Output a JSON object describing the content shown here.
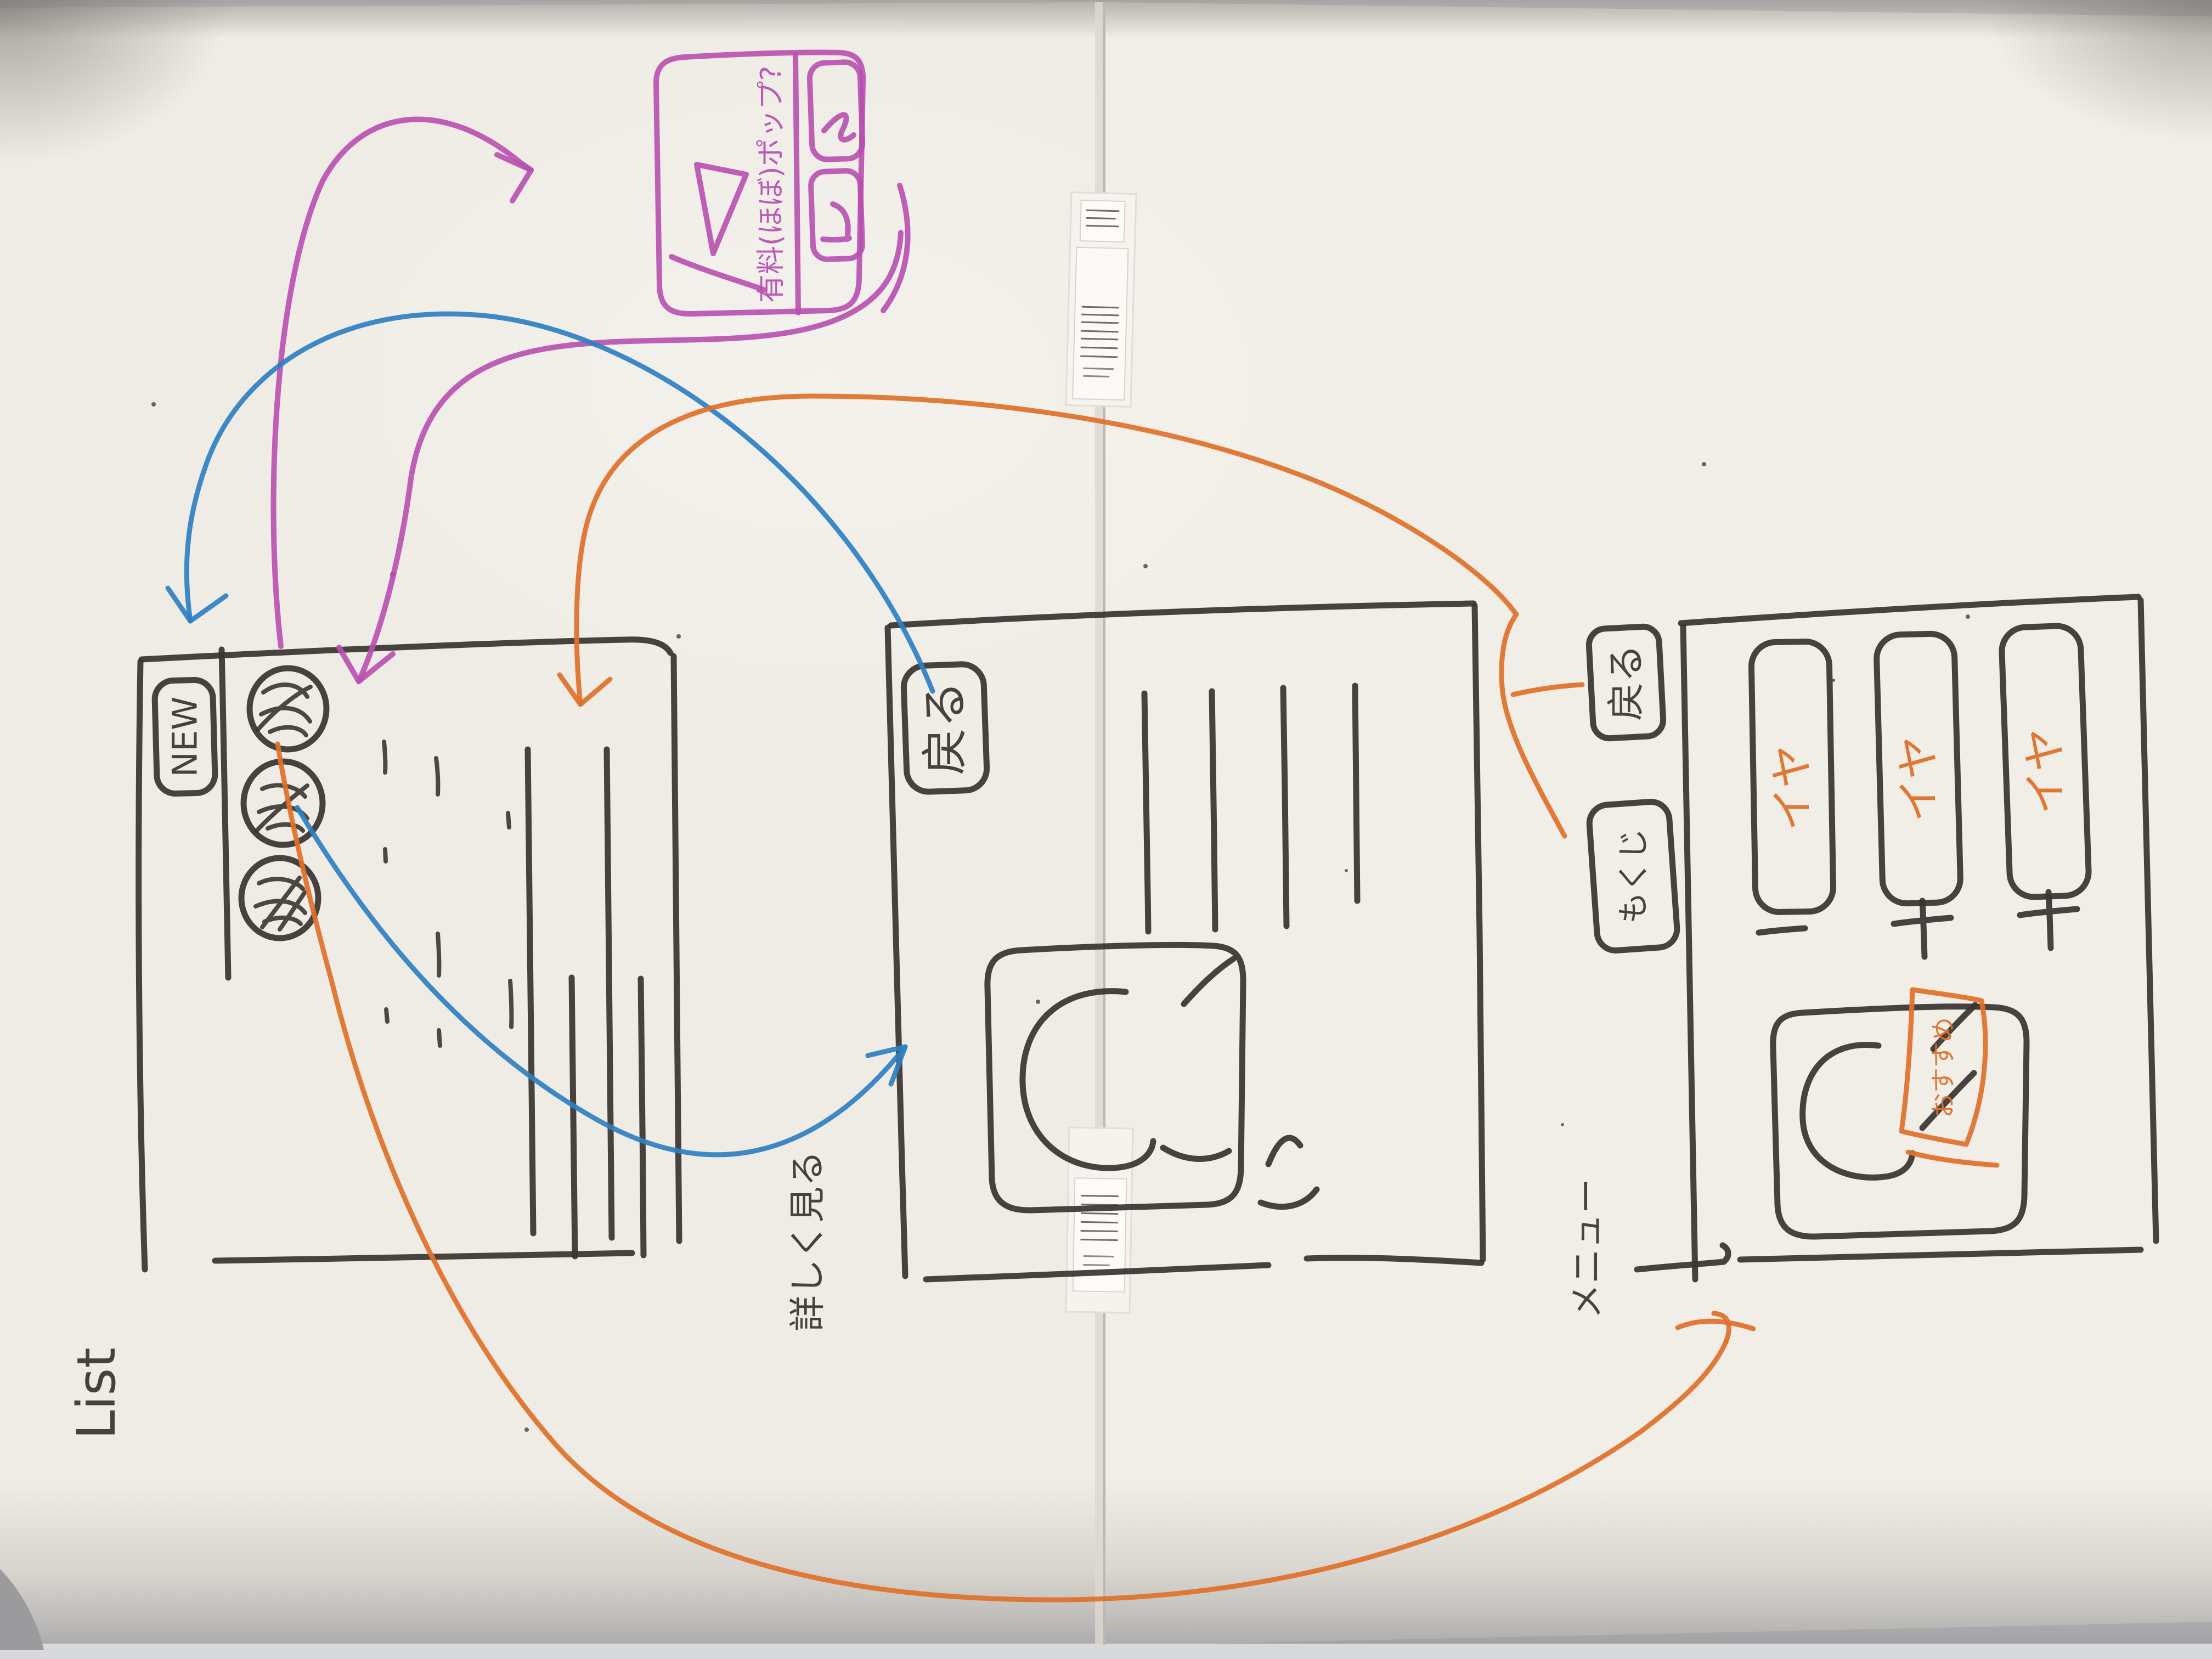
{
  "whiteboard": {
    "description": "hand-drawn mobile app wireframe flow sketch on two whiteboard panels",
    "colors": {
      "board": "#f0ede6",
      "ink": "#3a3531",
      "magenta": "#b84fb0",
      "blue": "#2e7fc2",
      "orange": "#e0712a",
      "floor": "#cdced1",
      "tape": "#f5f3ee"
    }
  },
  "screens": {
    "list": {
      "title": "List",
      "new_button": "NEW",
      "avatars": [
        "scribble-avatar-1",
        "scribble-avatar-2",
        "scribble-avatar-3"
      ]
    },
    "detail": {
      "title": "詳しく見る",
      "back_button": "戻る",
      "image": "face-sketch"
    },
    "menu": {
      "title": "メニュー",
      "back_button": "戻る",
      "toc_button": "もくじ",
      "cards": [
        {
          "label": "イヤ"
        },
        {
          "label": "イヤ"
        },
        {
          "label": "イヤ"
        }
      ],
      "featured": {
        "tag": "おすすめ",
        "image": "face-sketch"
      }
    }
  },
  "modal": {
    "message": "有料(ほぼ)ポップ?",
    "play_icon": "play-triangle",
    "buttons": [
      {
        "glyph": "scribble-glyph-1"
      },
      {
        "glyph": "scribble-glyph-2"
      }
    ]
  },
  "arrows": [
    {
      "color": "magenta",
      "from": "list-avatars",
      "to": "modal"
    },
    {
      "color": "magenta",
      "from": "modal",
      "to": "list-header"
    },
    {
      "color": "blue",
      "from": "detail-back-button",
      "to": "list-header"
    },
    {
      "color": "blue",
      "from": "list-avatars",
      "to": "detail-image"
    },
    {
      "color": "orange",
      "from": "menu-back-button",
      "to": "list-header"
    },
    {
      "color": "orange",
      "from": "list-avatars",
      "to": "menu-screen-bottom"
    }
  ]
}
